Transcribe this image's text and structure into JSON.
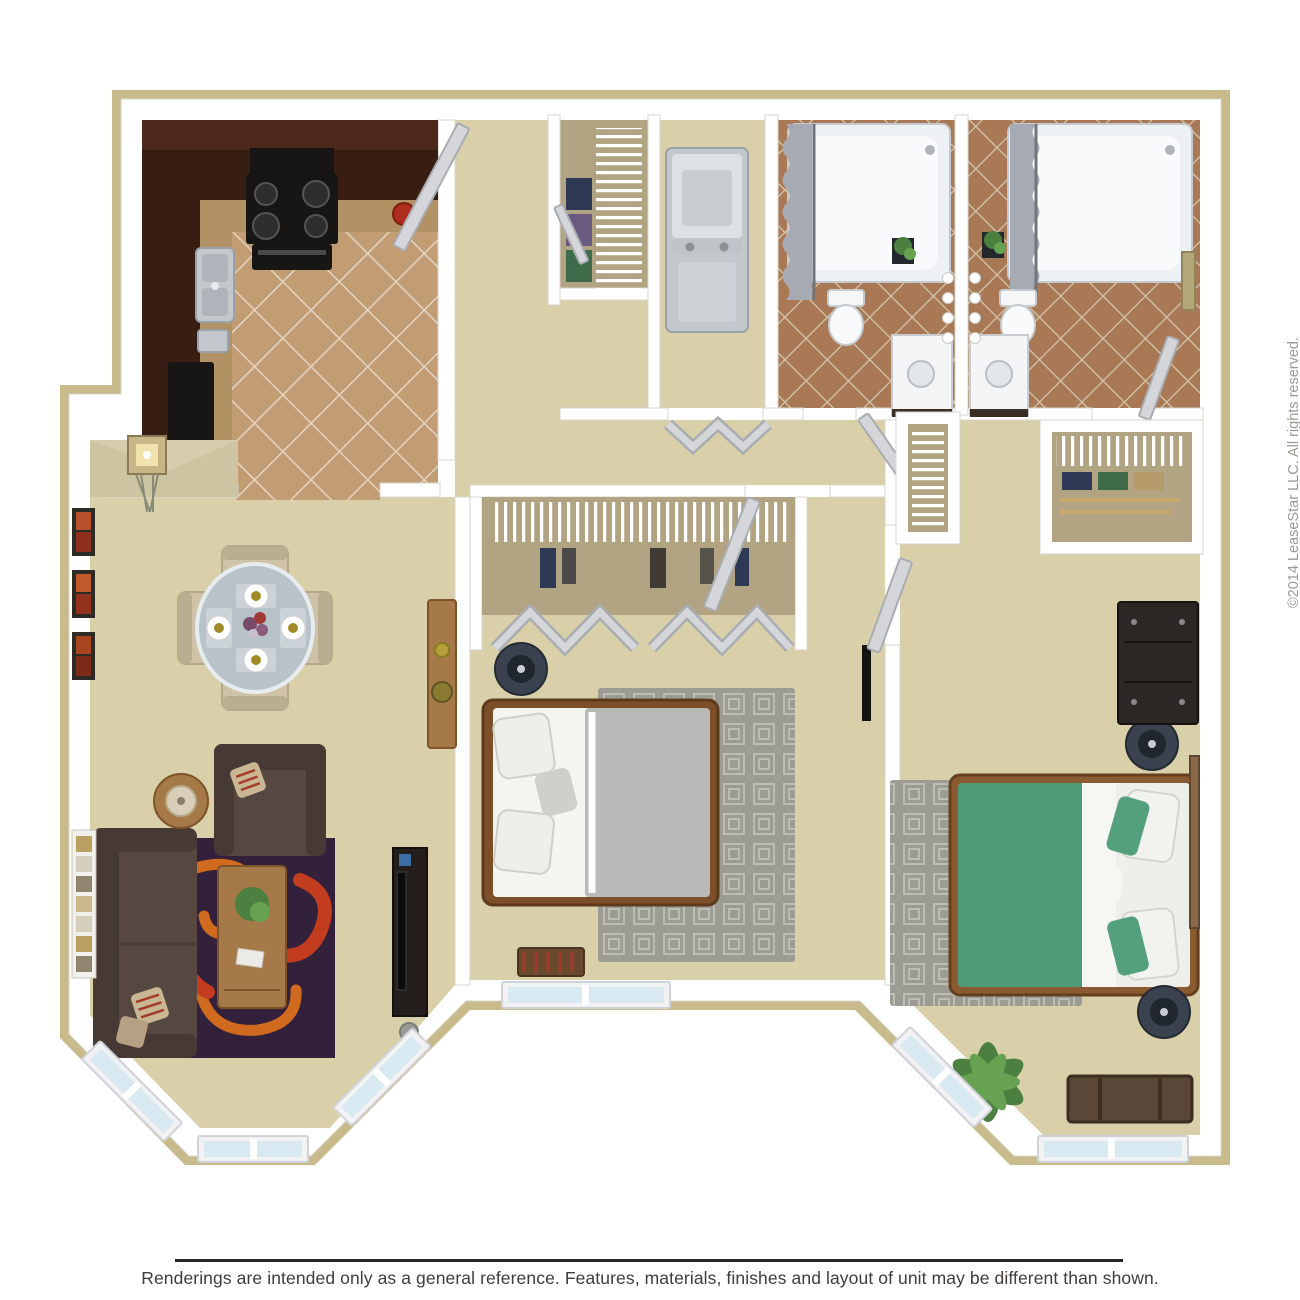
{
  "page": {
    "background": "#ffffff"
  },
  "footer": {
    "text": "Renderings are intended only as a general reference. Features, materials, finishes and layout of unit may be different than shown."
  },
  "watermark": {
    "text": "©2014 LeaseStar LLC. All rights reserved."
  },
  "colors": {
    "exterior_wall": "#c9ba8b",
    "wall_white": "#ffffff",
    "carpet": "#d9d0a9",
    "entry_shade": "#cdc4a2",
    "kitchen_tile": "#c29c73",
    "kitchen_grout": "#e3d5c0",
    "bath_tile": "#a87954",
    "bath_grout": "#d6c6ae",
    "cabinet": "#371d12",
    "cabinet_hi": "#4b281a",
    "counter": "#b09265",
    "appliance_black": "#171614",
    "steel": "#c3c8cd",
    "steel_dark": "#9aa1a8",
    "tub": "#eef1f3",
    "curtain": "#a6abb3",
    "linen_white": "#f6f6f3",
    "door_leaf": "#d4d6d9",
    "door_edge": "#a9adb2",
    "window_frame": "#f2f1f4",
    "window_glass": "#d9e9f1",
    "sofa": "#564741",
    "sofa_dark": "#473a35",
    "rug_base": "#33203a",
    "rug_swirl_red": "#c23d1f",
    "rug_swirl_orange": "#d06a1f",
    "wood": "#a57a48",
    "wood_dark": "#7d5429",
    "table_glass": "#b7c2c9",
    "chair_beige": "#cec3a6",
    "bed1_duvet": "#b8bab7",
    "bed2_duvet": "#4f9a77",
    "pillow_gray": "#cfcfcb",
    "bed_frame": "#7c4f28",
    "bedroom_rug": "#9c9c94",
    "rug_line": "#bdbdb5",
    "nightstand": "#39424e",
    "lamp_dark": "#20262d",
    "closet_floor": "#b2a383",
    "dresser_dark": "#2b2725",
    "trunk_brown": "#5b4737",
    "plant": "#4c8040",
    "plant_light": "#66a251",
    "accent_red": "#b02c1d",
    "text_dark": "#2b2624",
    "text_muted": "#9b9995"
  }
}
